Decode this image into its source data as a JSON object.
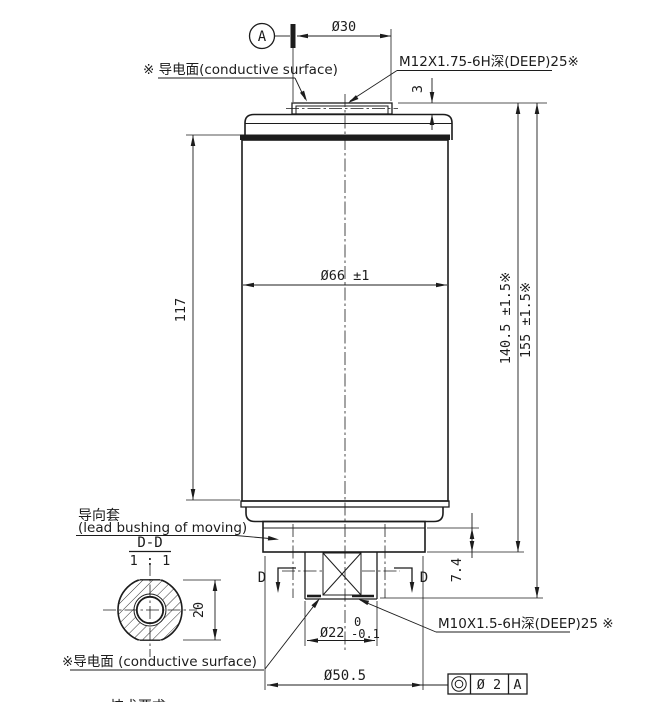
{
  "labels": {
    "datum": "A",
    "dia30": "Ø30",
    "m12_note": "M12X1.75-6H深(DEEP)25※",
    "conductive_top": "※ 导电面(conductive surface)",
    "dim_3": "3",
    "dia66": "Ø66 ±1",
    "dim_117": "117",
    "dim_140_5": "140.5 ±1.5※",
    "dim_155": "155 ±1.5※",
    "bushing_cn": "导向套",
    "bushing_en": "(lead bushing of moving)",
    "section_title": "D-D",
    "section_scale": "1 : 1",
    "dim_20": "20",
    "d_left": "D",
    "d_right": "D",
    "dim_7_4": "7.4",
    "m10_note": "M10X1.5-6H深(DEEP)25 ※",
    "dia22": "Ø22",
    "dia22_tol_upper": "0",
    "dia22_tol_lower": "-0.1",
    "conductive_bottom": "※导电面 (conductive surface)",
    "dia50_5": "Ø50.5",
    "fcf_tolerance": "Ø 2",
    "fcf_datum": "A",
    "partial_note": "技术要求"
  },
  "colors": {
    "line": "#1c1c1c",
    "background": "#ffffff"
  }
}
